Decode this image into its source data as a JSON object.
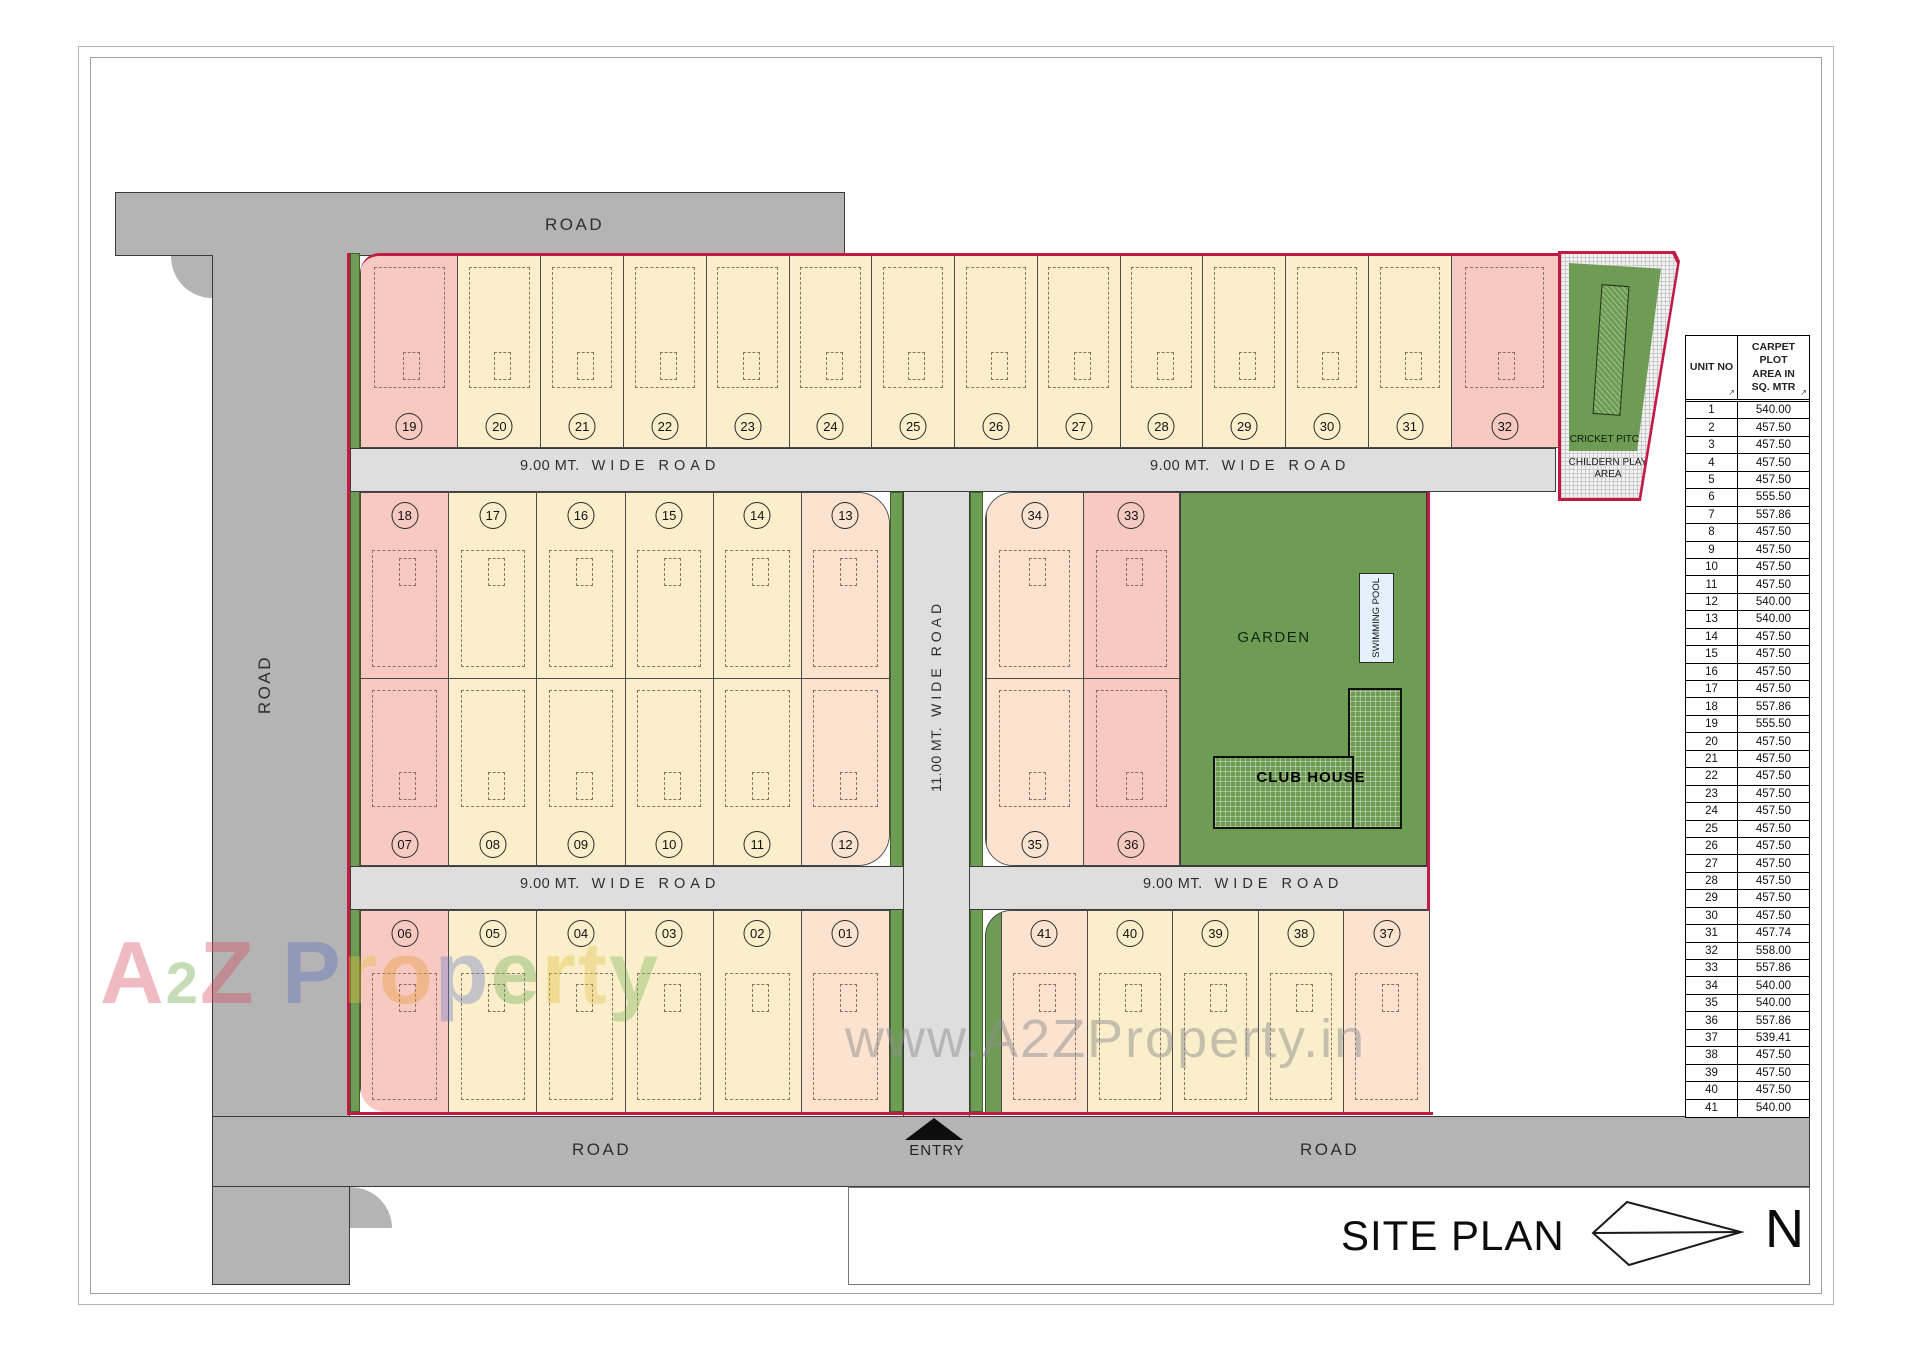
{
  "plan": {
    "road_label": "ROAD",
    "road9_a": "9.00 MT.",
    "road9_b": "WIDE ROAD",
    "road11_a": "11.00 MT.",
    "road11_b": "WIDE ROAD",
    "entry_label": "ENTRY",
    "garden_label": "GARDEN",
    "pool_label": "SWIMMING POOL",
    "clubhouse_label": "CLUB HOUSE",
    "cricket_label": "CRICKET PITCH",
    "play_label": "CHILDERN PLAY AREA",
    "colors": {
      "boundary": "#c21945",
      "plot_cream": "#faefca",
      "plot_pink": "#f8c9c0",
      "plot_peach": "#fce3d0",
      "green": "#6f9c55",
      "road_outer": "#b4b4b4",
      "road_inner": "#dedede"
    },
    "blocks": {
      "top": [
        {
          "num": "19",
          "cls": "pink w-lg nb"
        },
        {
          "num": "20",
          "cls": "cream nb"
        },
        {
          "num": "21",
          "cls": "cream nb"
        },
        {
          "num": "22",
          "cls": "cream nb"
        },
        {
          "num": "23",
          "cls": "cream nb"
        },
        {
          "num": "24",
          "cls": "cream nb"
        },
        {
          "num": "25",
          "cls": "cream nb"
        },
        {
          "num": "26",
          "cls": "cream nb"
        },
        {
          "num": "27",
          "cls": "cream nb"
        },
        {
          "num": "28",
          "cls": "cream nb"
        },
        {
          "num": "29",
          "cls": "cream nb"
        },
        {
          "num": "30",
          "cls": "cream nb"
        },
        {
          "num": "31",
          "cls": "cream nb"
        },
        {
          "num": "32",
          "cls": "pink w-xl nb"
        }
      ],
      "mid_left_r1": [
        {
          "num": "18",
          "cls": "pink nt"
        },
        {
          "num": "17",
          "cls": "cream nt"
        },
        {
          "num": "16",
          "cls": "cream nt"
        },
        {
          "num": "15",
          "cls": "cream nt"
        },
        {
          "num": "14",
          "cls": "cream nt"
        },
        {
          "num": "13",
          "cls": "peach nt"
        }
      ],
      "mid_left_r2": [
        {
          "num": "07",
          "cls": "pink nb"
        },
        {
          "num": "08",
          "cls": "cream nb"
        },
        {
          "num": "09",
          "cls": "cream nb"
        },
        {
          "num": "10",
          "cls": "cream nb"
        },
        {
          "num": "11",
          "cls": "cream nb"
        },
        {
          "num": "12",
          "cls": "peach nb"
        }
      ],
      "mid_right_r1": [
        {
          "num": "34",
          "cls": "peach nt"
        },
        {
          "num": "33",
          "cls": "pink nt"
        }
      ],
      "mid_right_r2": [
        {
          "num": "35",
          "cls": "peach nb"
        },
        {
          "num": "36",
          "cls": "pink nb"
        }
      ],
      "bottom_left": [
        {
          "num": "06",
          "cls": "pink nt"
        },
        {
          "num": "05",
          "cls": "cream nt"
        },
        {
          "num": "04",
          "cls": "cream nt"
        },
        {
          "num": "03",
          "cls": "cream nt"
        },
        {
          "num": "02",
          "cls": "cream nt"
        },
        {
          "num": "01",
          "cls": "peach nt"
        }
      ],
      "bottom_right": [
        {
          "num": "41",
          "cls": "peach nt"
        },
        {
          "num": "40",
          "cls": "cream nt"
        },
        {
          "num": "39",
          "cls": "cream nt"
        },
        {
          "num": "38",
          "cls": "cream nt"
        },
        {
          "num": "37",
          "cls": "peach nt"
        }
      ]
    }
  },
  "table": {
    "header_unit": "UNIT NO",
    "header_area": "CARPET PLOT\nAREA IN\nSQ. MTR",
    "sort_mark": "↗",
    "rows": [
      [
        "1",
        "540.00"
      ],
      [
        "2",
        "457.50"
      ],
      [
        "3",
        "457.50"
      ],
      [
        "4",
        "457.50"
      ],
      [
        "5",
        "457.50"
      ],
      [
        "6",
        "555.50"
      ],
      [
        "7",
        "557.86"
      ],
      [
        "8",
        "457.50"
      ],
      [
        "9",
        "457.50"
      ],
      [
        "10",
        "457.50"
      ],
      [
        "11",
        "457.50"
      ],
      [
        "12",
        "540.00"
      ],
      [
        "13",
        "540.00"
      ],
      [
        "14",
        "457.50"
      ],
      [
        "15",
        "457.50"
      ],
      [
        "16",
        "457.50"
      ],
      [
        "17",
        "457.50"
      ],
      [
        "18",
        "557.86"
      ],
      [
        "19",
        "555.50"
      ],
      [
        "20",
        "457.50"
      ],
      [
        "21",
        "457.50"
      ],
      [
        "22",
        "457.50"
      ],
      [
        "23",
        "457.50"
      ],
      [
        "24",
        "457.50"
      ],
      [
        "25",
        "457.50"
      ],
      [
        "26",
        "457.50"
      ],
      [
        "27",
        "457.50"
      ],
      [
        "28",
        "457.50"
      ],
      [
        "29",
        "457.50"
      ],
      [
        "30",
        "457.50"
      ],
      [
        "31",
        "457.74"
      ],
      [
        "32",
        "558.00"
      ],
      [
        "33",
        "557.86"
      ],
      [
        "34",
        "540.00"
      ],
      [
        "35",
        "540.00"
      ],
      [
        "36",
        "557.86"
      ],
      [
        "37",
        "539.41"
      ],
      [
        "38",
        "457.50"
      ],
      [
        "39",
        "457.50"
      ],
      [
        "40",
        "457.50"
      ],
      [
        "41",
        "540.00"
      ]
    ]
  },
  "titleblock": {
    "title": "SITE PLAN",
    "north": "N"
  },
  "watermarks": {
    "www": "www.A2ZProperty.in",
    "logo_letters": [
      {
        "ch": "A",
        "c": "#d84b62",
        "cls": ""
      },
      {
        "ch": "2",
        "c": "#6aa644",
        "cls": "sm"
      },
      {
        "ch": "Z",
        "c": "#d84b62",
        "cls": ""
      },
      {
        "ch": " ",
        "c": "#000000",
        "cls": ""
      },
      {
        "ch": "P",
        "c": "#5a6fc0",
        "cls": ""
      },
      {
        "ch": "r",
        "c": "#e3bf3b",
        "cls": ""
      },
      {
        "ch": "o",
        "c": "#e59a39",
        "cls": ""
      },
      {
        "ch": "p",
        "c": "#6b7ec9",
        "cls": ""
      },
      {
        "ch": "e",
        "c": "#6fae57",
        "cls": ""
      },
      {
        "ch": "r",
        "c": "#e3bf3b",
        "cls": ""
      },
      {
        "ch": "t",
        "c": "#e3c14e",
        "cls": ""
      },
      {
        "ch": "y",
        "c": "#7ab35b",
        "cls": ""
      }
    ]
  }
}
